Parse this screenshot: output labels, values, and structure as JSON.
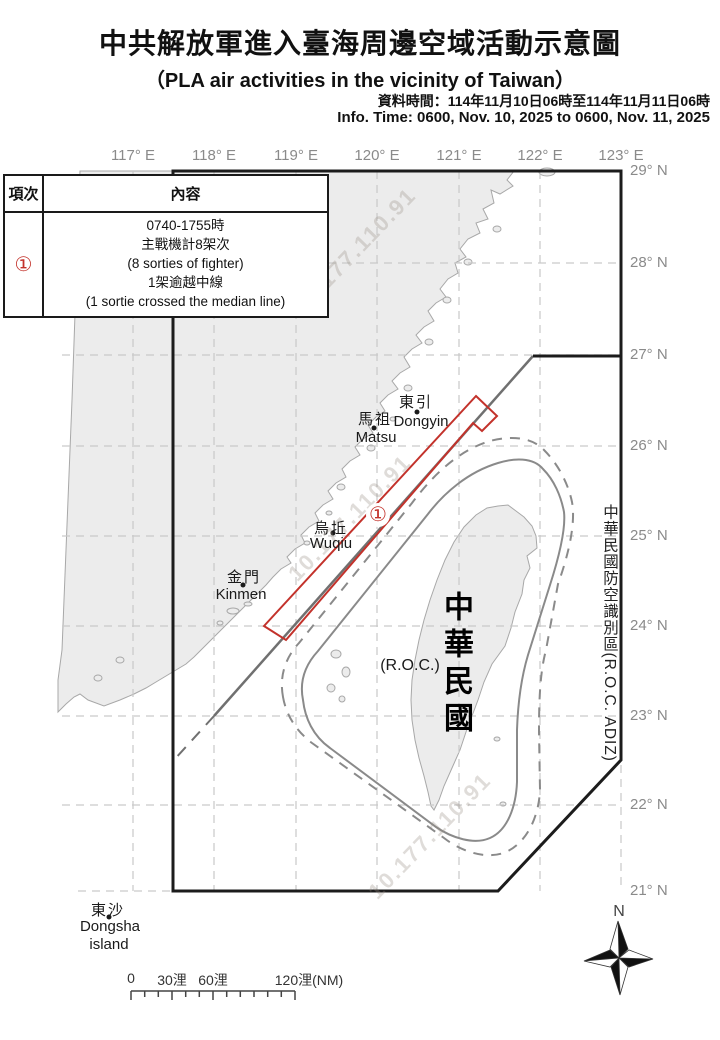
{
  "header": {
    "title_zh": "中共解放軍進入臺海周邊空域活動示意圖",
    "title_en": "（PLA air activities in the vicinity of Taiwan）",
    "info_zh": "資料時間：114年11月10日06時至114年11月11日06時",
    "info_en": "Info. Time: 0600, Nov. 10, 2025 to 0600, Nov. 11, 2025"
  },
  "table": {
    "col_item": "項次",
    "col_content": "內容",
    "row": {
      "id": "①",
      "lines": [
        "0740-1755時",
        "主戰機計8架次",
        "(8 sorties of fighter)",
        "1架逾越中線",
        "(1 sortie crossed the median line)"
      ]
    }
  },
  "map": {
    "lon_labels": [
      "117° E",
      "118° E",
      "119° E",
      "120° E",
      "121° E",
      "122° E",
      "123° E"
    ],
    "lat_labels": [
      "29° N",
      "28° N",
      "27° N",
      "26° N",
      "25° N",
      "24° N",
      "23° N",
      "22° N",
      "21° N"
    ],
    "places": {
      "dongyin": {
        "zh": "東引",
        "en": "Dongyin"
      },
      "matsu": {
        "zh": "馬祖",
        "en": "Matsu"
      },
      "wuqiu": {
        "zh": "烏坵",
        "en": "Wuqiu"
      },
      "kinmen": {
        "zh": "金門",
        "en": "Kinmen"
      },
      "dongsha": {
        "zh": "東沙",
        "en1": "Dongsha",
        "en2": "island"
      }
    },
    "taiwan_label_zh": "中華民國",
    "taiwan_label_en": "(R.O.C.)",
    "adiz_label": "中華民國防空識別區(R.O.C. ADIZ)",
    "activity_marker": "①",
    "compass_n": "N"
  },
  "scalebar": {
    "labels": [
      "0",
      "30浬",
      "60浬",
      "120浬(NM)"
    ]
  },
  "watermark": "10.177.110.91",
  "colors": {
    "accent_red": "#C3322B",
    "land_fill": "#ECECEC",
    "coast_stroke": "#A8A8A8",
    "grid_gray": "#C9C9C9",
    "adiz_black": "#1C1C1C",
    "median_gray": "#707070",
    "contour_gray": "#8A8A8A",
    "label_gray": "#8A8A8A"
  }
}
